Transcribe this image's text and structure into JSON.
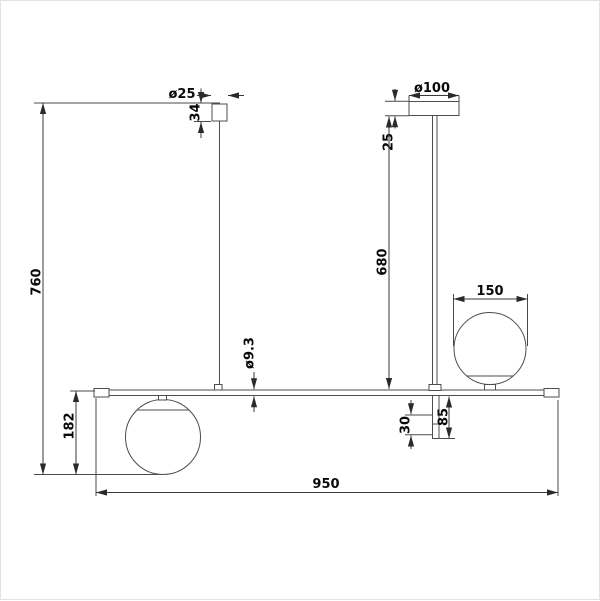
{
  "drawing": {
    "background": "#ffffff",
    "line_color": "#4d4d4d",
    "text_color": "#0a0a0a",
    "labels": {
      "small_canopy_diameter": "ø25",
      "small_canopy_height": "34",
      "large_canopy_diameter": "ø100",
      "large_canopy_height": "25",
      "overall_drop": "760",
      "stem_length": "680",
      "globe_diameter": "150",
      "bar_diameter": "ø9.3",
      "left_globe_drop": "182",
      "socket_section": "30",
      "lower_stem": "85",
      "overall_width": "950"
    }
  }
}
